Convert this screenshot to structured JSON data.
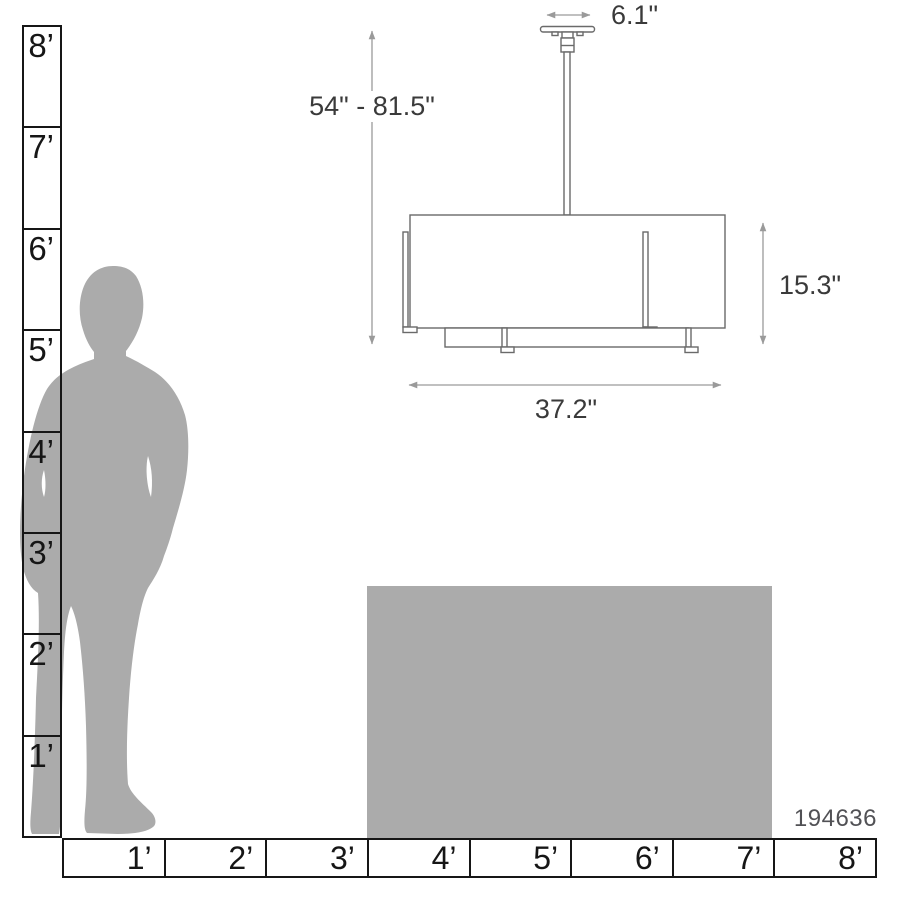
{
  "diagram": {
    "product_code": "194636",
    "dimensions": {
      "canopy_width": "6.1\"",
      "overall_height": "54\" - 81.5\"",
      "shade_height": "15.3\"",
      "shade_width": "37.2\""
    },
    "rulers": {
      "vertical": {
        "labels": [
          "8’",
          "7’",
          "6’",
          "5’",
          "4’",
          "3’",
          "2’",
          "1’"
        ]
      },
      "horizontal": {
        "labels": [
          "1’",
          "2’",
          "3’",
          "4’",
          "5’",
          "6’",
          "7’",
          "8’"
        ]
      }
    },
    "colors": {
      "silhouette_gray": "#ABABAB",
      "table_gray": "#ABABAB",
      "fixture_line": "#6A6A6A",
      "dimension_line": "#9A9A9A",
      "dimension_text": "#3A3A3A",
      "ruler_line": "#161616",
      "code_text": "#515155"
    }
  }
}
